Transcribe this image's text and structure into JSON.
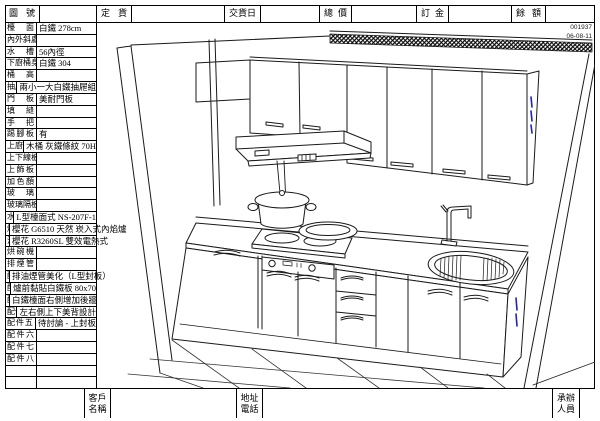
{
  "meta": {
    "doc_no": "001937",
    "doc_date": "06-08-11"
  },
  "header": {
    "fields": [
      {
        "label": "圖號",
        "value": ""
      },
      {
        "label": "定貨日",
        "value": ""
      },
      {
        "label": "交貨日",
        "value": ""
      },
      {
        "label": "總價",
        "value": ""
      },
      {
        "label": "訂金",
        "value": ""
      },
      {
        "label": "餘額",
        "value": ""
      }
    ]
  },
  "spec_table": {
    "rows": [
      {
        "label": "檯面",
        "value": "白鐵 278cm"
      },
      {
        "label": "內外斜處",
        "value": ""
      },
      {
        "label": "水槽",
        "value": "56內徑"
      },
      {
        "label": "下廚桶身",
        "value": "白鐵 304"
      },
      {
        "label": "桶高",
        "value": ""
      },
      {
        "label": "抽屜",
        "value": "兩小一大白鐵抽屜組"
      },
      {
        "label": "門板",
        "value": "美耐門板"
      },
      {
        "label": "填縫",
        "value": ""
      },
      {
        "label": "手把",
        "value": ""
      },
      {
        "label": "踢腳板",
        "value": "有"
      },
      {
        "label": "上廚桶身",
        "value": "木桶 灰鐵條紋 70H"
      },
      {
        "label": "上下線板",
        "value": ""
      },
      {
        "label": "上飾板",
        "value": ""
      },
      {
        "label": "加色顏",
        "value": ""
      },
      {
        "label": "玻璃",
        "value": ""
      },
      {
        "label": "玻璃隔板",
        "value": ""
      },
      {
        "label": "水龍頭",
        "value": "L型檯面式 NS-207F-1"
      },
      {
        "label": "爐具",
        "value": "櫻花 G6510 天然 崁入式內焰爐"
      },
      {
        "label": "油機",
        "value": "櫻花 R3260SL 雙效電熱式"
      },
      {
        "label": "烘碗機",
        "value": ""
      },
      {
        "label": "排煙管",
        "value": ""
      },
      {
        "label": "配件一",
        "value": "排油煙管美化（L型封板）"
      },
      {
        "label": "配件二",
        "value": "爐前黏貼白鐵板 80x70"
      },
      {
        "label": "配件三",
        "value": "白鐵檯面右側增加後牆"
      },
      {
        "label": "配件四",
        "value": "左右側上下美背設計"
      },
      {
        "label": "配件五",
        "value": "待討論 - 上封板"
      },
      {
        "label": "配件六",
        "value": ""
      },
      {
        "label": "配件七",
        "value": ""
      },
      {
        "label": "配件八",
        "value": ""
      },
      {
        "label": "",
        "value": ""
      },
      {
        "label": "",
        "value": ""
      }
    ]
  },
  "footer": {
    "fields": [
      {
        "l1": "客戶",
        "l2": "名稱",
        "value": ""
      },
      {
        "l1": "地址",
        "l2": "電話",
        "value": ""
      },
      {
        "l1": "承辦",
        "l2": "人員",
        "value": ""
      }
    ]
  },
  "drawing": {
    "note_color": "#2323b8",
    "line_color": "#1a1a1a"
  }
}
